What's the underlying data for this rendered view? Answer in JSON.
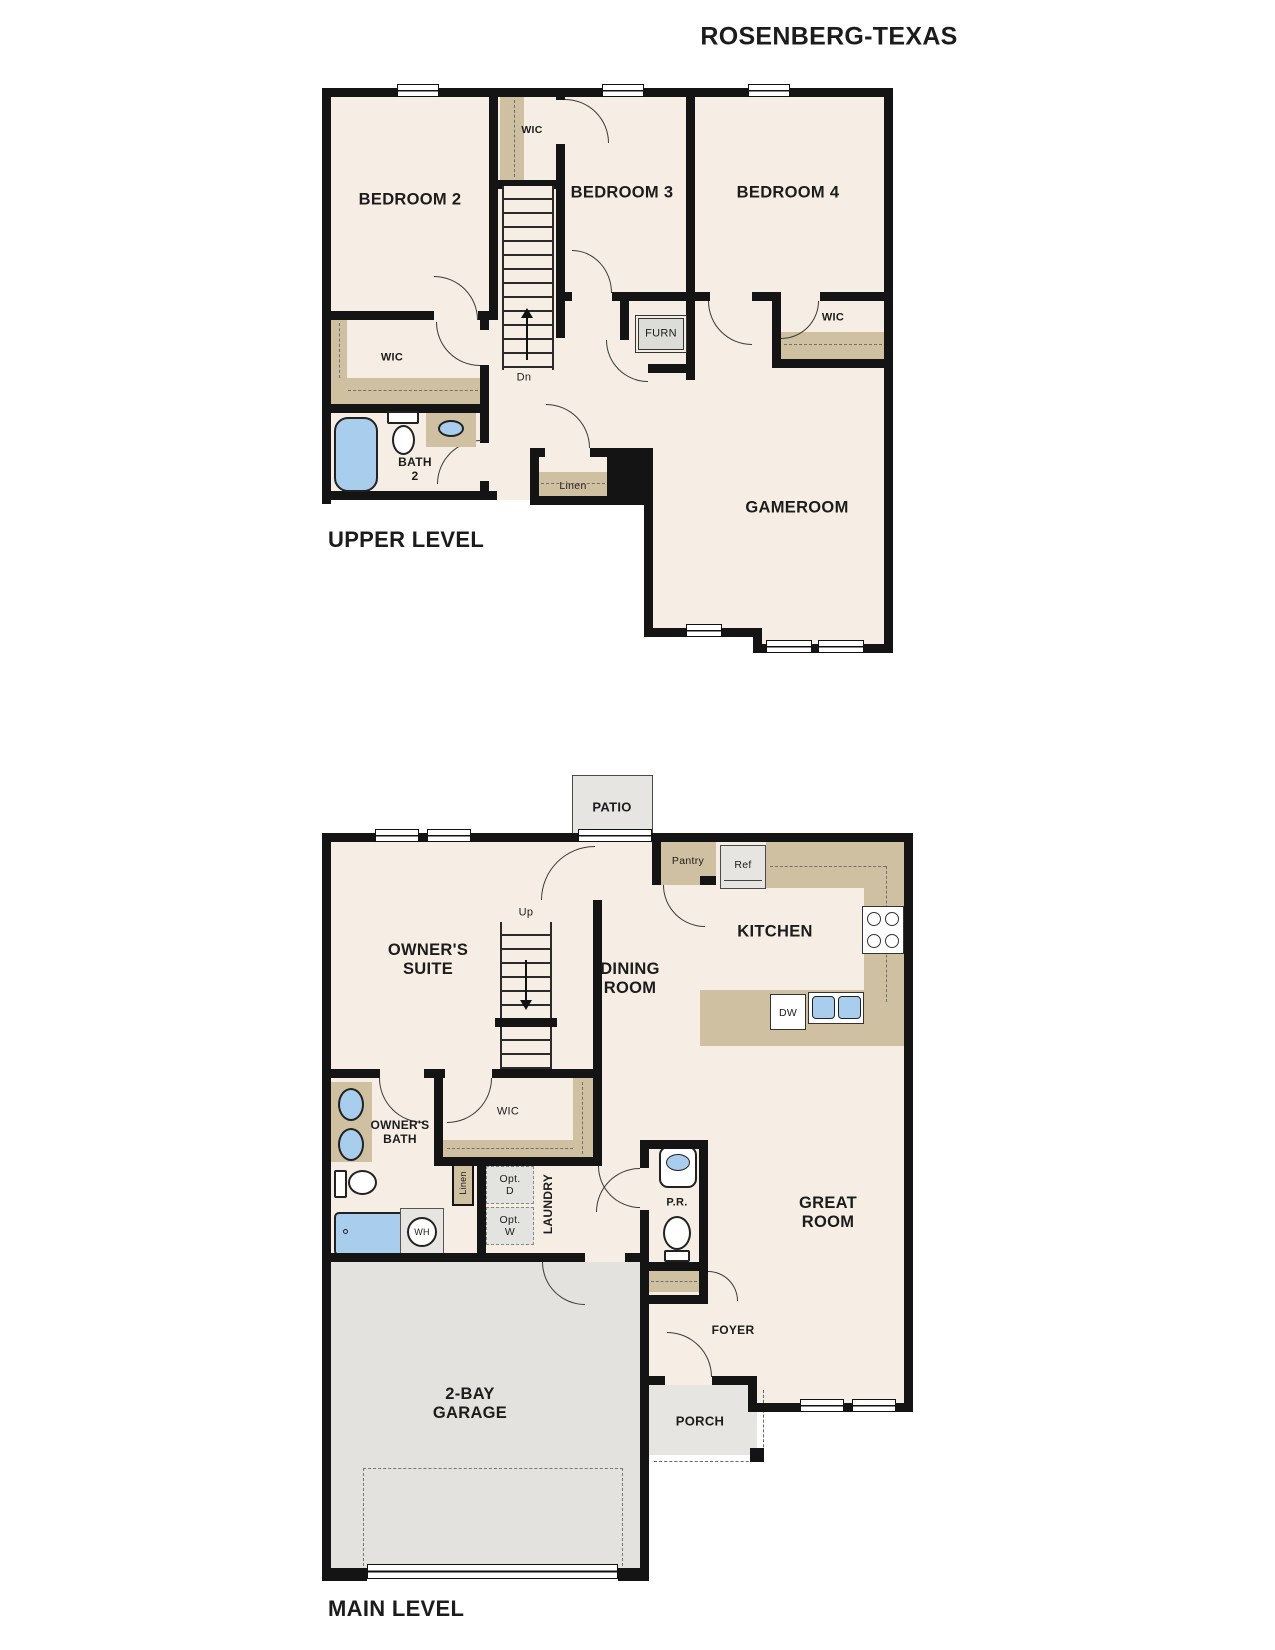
{
  "title": "ROSENBERG-TEXAS",
  "colors": {
    "floor": "#f6eee5",
    "wall": "#141414",
    "closet_shelf_tan": "#cfc0a2",
    "appliance_gray": "#e7e5e1",
    "garage_gray": "#e4e2df",
    "fixture_blue": "#a9cdec"
  },
  "upper": {
    "level_label": "UPPER LEVEL",
    "labels": {
      "bedroom2": "BEDROOM 2",
      "bedroom3": "BEDROOM 3",
      "bedroom4": "BEDROOM 4",
      "gameroom": "GAMEROOM",
      "bath2": "BATH\n2",
      "wic_stair": "WIC",
      "wic_bed2": "WIC",
      "wic_bed4": "WIC",
      "furn": "FURN",
      "linen": "Linen",
      "dn": "Dn"
    }
  },
  "main": {
    "level_label": "MAIN LEVEL",
    "labels": {
      "patio": "PATIO",
      "pantry": "Pantry",
      "ref": "Ref",
      "kitchen": "KITCHEN",
      "dining": "DINING\nROOM",
      "owners_suite": "OWNER'S\nSUITE",
      "owners_bath": "OWNER'S\nBATH",
      "wic": "WIC",
      "linen": "Linen",
      "laundry": "LAUNDRY",
      "opt_d": "Opt.\nD",
      "opt_w": "Opt.\nW",
      "wh": "WH",
      "pr": "P.R.",
      "great_room": "GREAT\nROOM",
      "foyer": "FOYER",
      "garage": "2-BAY\nGARAGE",
      "porch": "PORCH",
      "up": "Up",
      "dw": "DW"
    }
  }
}
